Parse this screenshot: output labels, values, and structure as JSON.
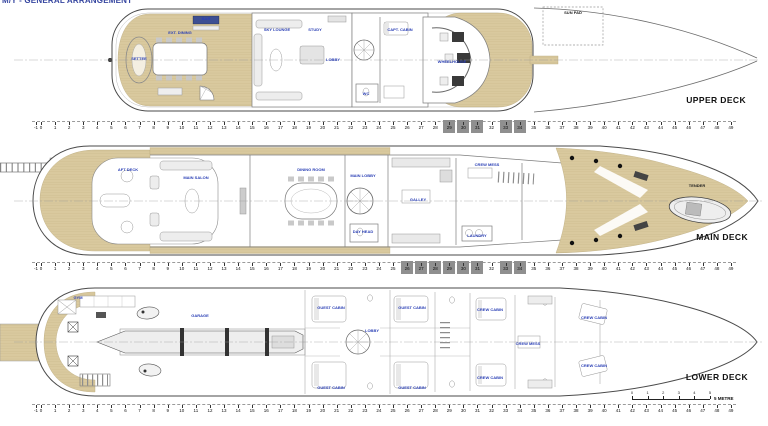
{
  "title": {
    "text": "M/Y - GENERAL ARRANGEMENT"
  },
  "colors": {
    "teak": "#d9c99e",
    "hull_line": "#4a4a4a",
    "label_blue": "#2a3fb5",
    "deck_name": "#111111",
    "marker_gray": "#8f8f8f"
  },
  "decks": [
    {
      "id": "upper",
      "name": "UPPER DECK",
      "labels": [
        {
          "t": "BAR",
          "x": 206,
          "y": 19
        },
        {
          "t": "EXT. DINING",
          "x": 180,
          "y": 33
        },
        {
          "t": "SETTEE",
          "x": 139,
          "y": 59
        },
        {
          "t": "SKY LOUNGE",
          "x": 277,
          "y": 30
        },
        {
          "t": "STUDY",
          "x": 315,
          "y": 30
        },
        {
          "t": "LOBBY",
          "x": 333,
          "y": 60
        },
        {
          "t": "WC",
          "x": 366,
          "y": 94
        },
        {
          "t": "CAPT. CABIN",
          "x": 400,
          "y": 30
        },
        {
          "t": "WHEELHOUSE",
          "x": 452,
          "y": 62
        },
        {
          "t": "SUN PAD",
          "x": 573,
          "y": 13,
          "k": 1
        }
      ]
    },
    {
      "id": "main",
      "name": "MAIN DECK",
      "labels": [
        {
          "t": "AFT DECK",
          "x": 128,
          "y": 170
        },
        {
          "t": "MAIN SALON",
          "x": 196,
          "y": 178
        },
        {
          "t": "DINING ROOM",
          "x": 311,
          "y": 170
        },
        {
          "t": "MAIN LOBBY",
          "x": 363,
          "y": 176
        },
        {
          "t": "DAY HEAD",
          "x": 363,
          "y": 232
        },
        {
          "t": "GALLEY",
          "x": 418,
          "y": 200
        },
        {
          "t": "CREW MESS",
          "x": 487,
          "y": 165
        },
        {
          "t": "LAUNDRY",
          "x": 477,
          "y": 236
        },
        {
          "t": "TENDER",
          "x": 697,
          "y": 186,
          "k": 1
        }
      ]
    },
    {
      "id": "lower",
      "name": "LOWER DECK",
      "labels": [
        {
          "t": "GYM",
          "x": 78,
          "y": 298
        },
        {
          "t": "GARAGE",
          "x": 200,
          "y": 316
        },
        {
          "t": "GUEST CABIN",
          "x": 331,
          "y": 308
        },
        {
          "t": "GUEST CABIN",
          "x": 331,
          "y": 388
        },
        {
          "t": "GUEST CABIN",
          "x": 412,
          "y": 308
        },
        {
          "t": "GUEST CABIN",
          "x": 412,
          "y": 388
        },
        {
          "t": "LOBBY",
          "x": 372,
          "y": 331
        },
        {
          "t": "CREW CABIN",
          "x": 490,
          "y": 310
        },
        {
          "t": "CREW CABIN",
          "x": 490,
          "y": 378
        },
        {
          "t": "CREW MESS",
          "x": 528,
          "y": 344
        },
        {
          "t": "CREW CABIN",
          "x": 594,
          "y": 318
        },
        {
          "t": "CREW CABIN",
          "x": 594,
          "y": 366
        }
      ]
    }
  ],
  "rulers": {
    "start": -1,
    "end": 49,
    "x0": 41,
    "dx": 14.08,
    "x_neg1": 36,
    "rows": [
      {
        "y": 121,
        "boxes": [
          [
            29,
            31
          ],
          [
            33,
            34
          ]
        ]
      },
      {
        "y": 262,
        "boxes": [
          [
            26,
            31
          ],
          [
            33,
            34
          ]
        ]
      },
      {
        "y": 404,
        "boxes": []
      }
    ]
  },
  "scale_bar": {
    "x": 632,
    "y": 399,
    "len": 78,
    "labels": [
      "0",
      "1",
      "2",
      "3",
      "4",
      "5"
    ],
    "unit": "5 METRE"
  }
}
